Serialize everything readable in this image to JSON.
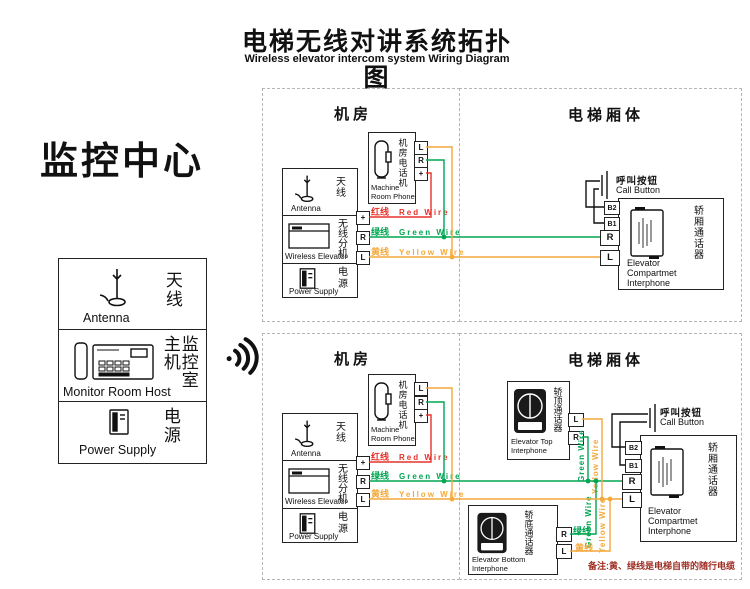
{
  "header": {
    "title_zh": "电梯无线对讲系统拓扑图",
    "title_en": "Wireless elevator intercom system Wiring Diagram"
  },
  "monitor": {
    "title": "监控中心",
    "antenna_zh": "天线",
    "antenna_en": "Antenna",
    "host_zh": "监控室\n主机",
    "host_en": "Monitor Room Host",
    "power_zh": "电源",
    "power_en": "Power Supply"
  },
  "labels": {
    "machine_room": "机房",
    "car_body": "电梯厢体",
    "antenna_zh": "天线",
    "antenna_en": "Antenna",
    "wireless_zh": "无线分机",
    "wireless_en": "Wireless Elevator",
    "power_zh": "电源",
    "power_en": "Power Supply",
    "phone_zh": "机房电话机",
    "phone_en1": "Machine",
    "phone_en2": "Room Phone",
    "red_zh": "红线",
    "red_en": "Red Wire",
    "green_zh": "绿线",
    "green_en": "Green Wire",
    "yellow_zh": "黄线",
    "yellow_en": "Yellow Wire",
    "call_zh": "呼叫按钮",
    "call_en": "Call Button",
    "comp_zh": "轿厢通话器",
    "comp_en1": "Elevator",
    "comp_en2": "Compartmet",
    "comp_en3": "Interphone",
    "top_zh": "轿顶通话器",
    "top_en1": "Elevator Top",
    "top_en2": "Interphone",
    "bottom_zh": "轿底通话器",
    "bottom_en1": "Elevator Bottom",
    "bottom_en2": "Interphone",
    "t_plus": "+",
    "t_r": "R",
    "t_l": "L",
    "t_b1": "B1",
    "t_b2": "B2",
    "green_wire": "Green Wire",
    "yellow_wire": "Yellow Wire"
  },
  "note": {
    "text": "备注:黄、绿线是电梯自带的随行电缆"
  },
  "colors": {
    "red": "#e8312a",
    "green": "#00a551",
    "yellow": "#f4a93c",
    "note_red": "#9e2d22",
    "dash": "#b5b5b5"
  }
}
